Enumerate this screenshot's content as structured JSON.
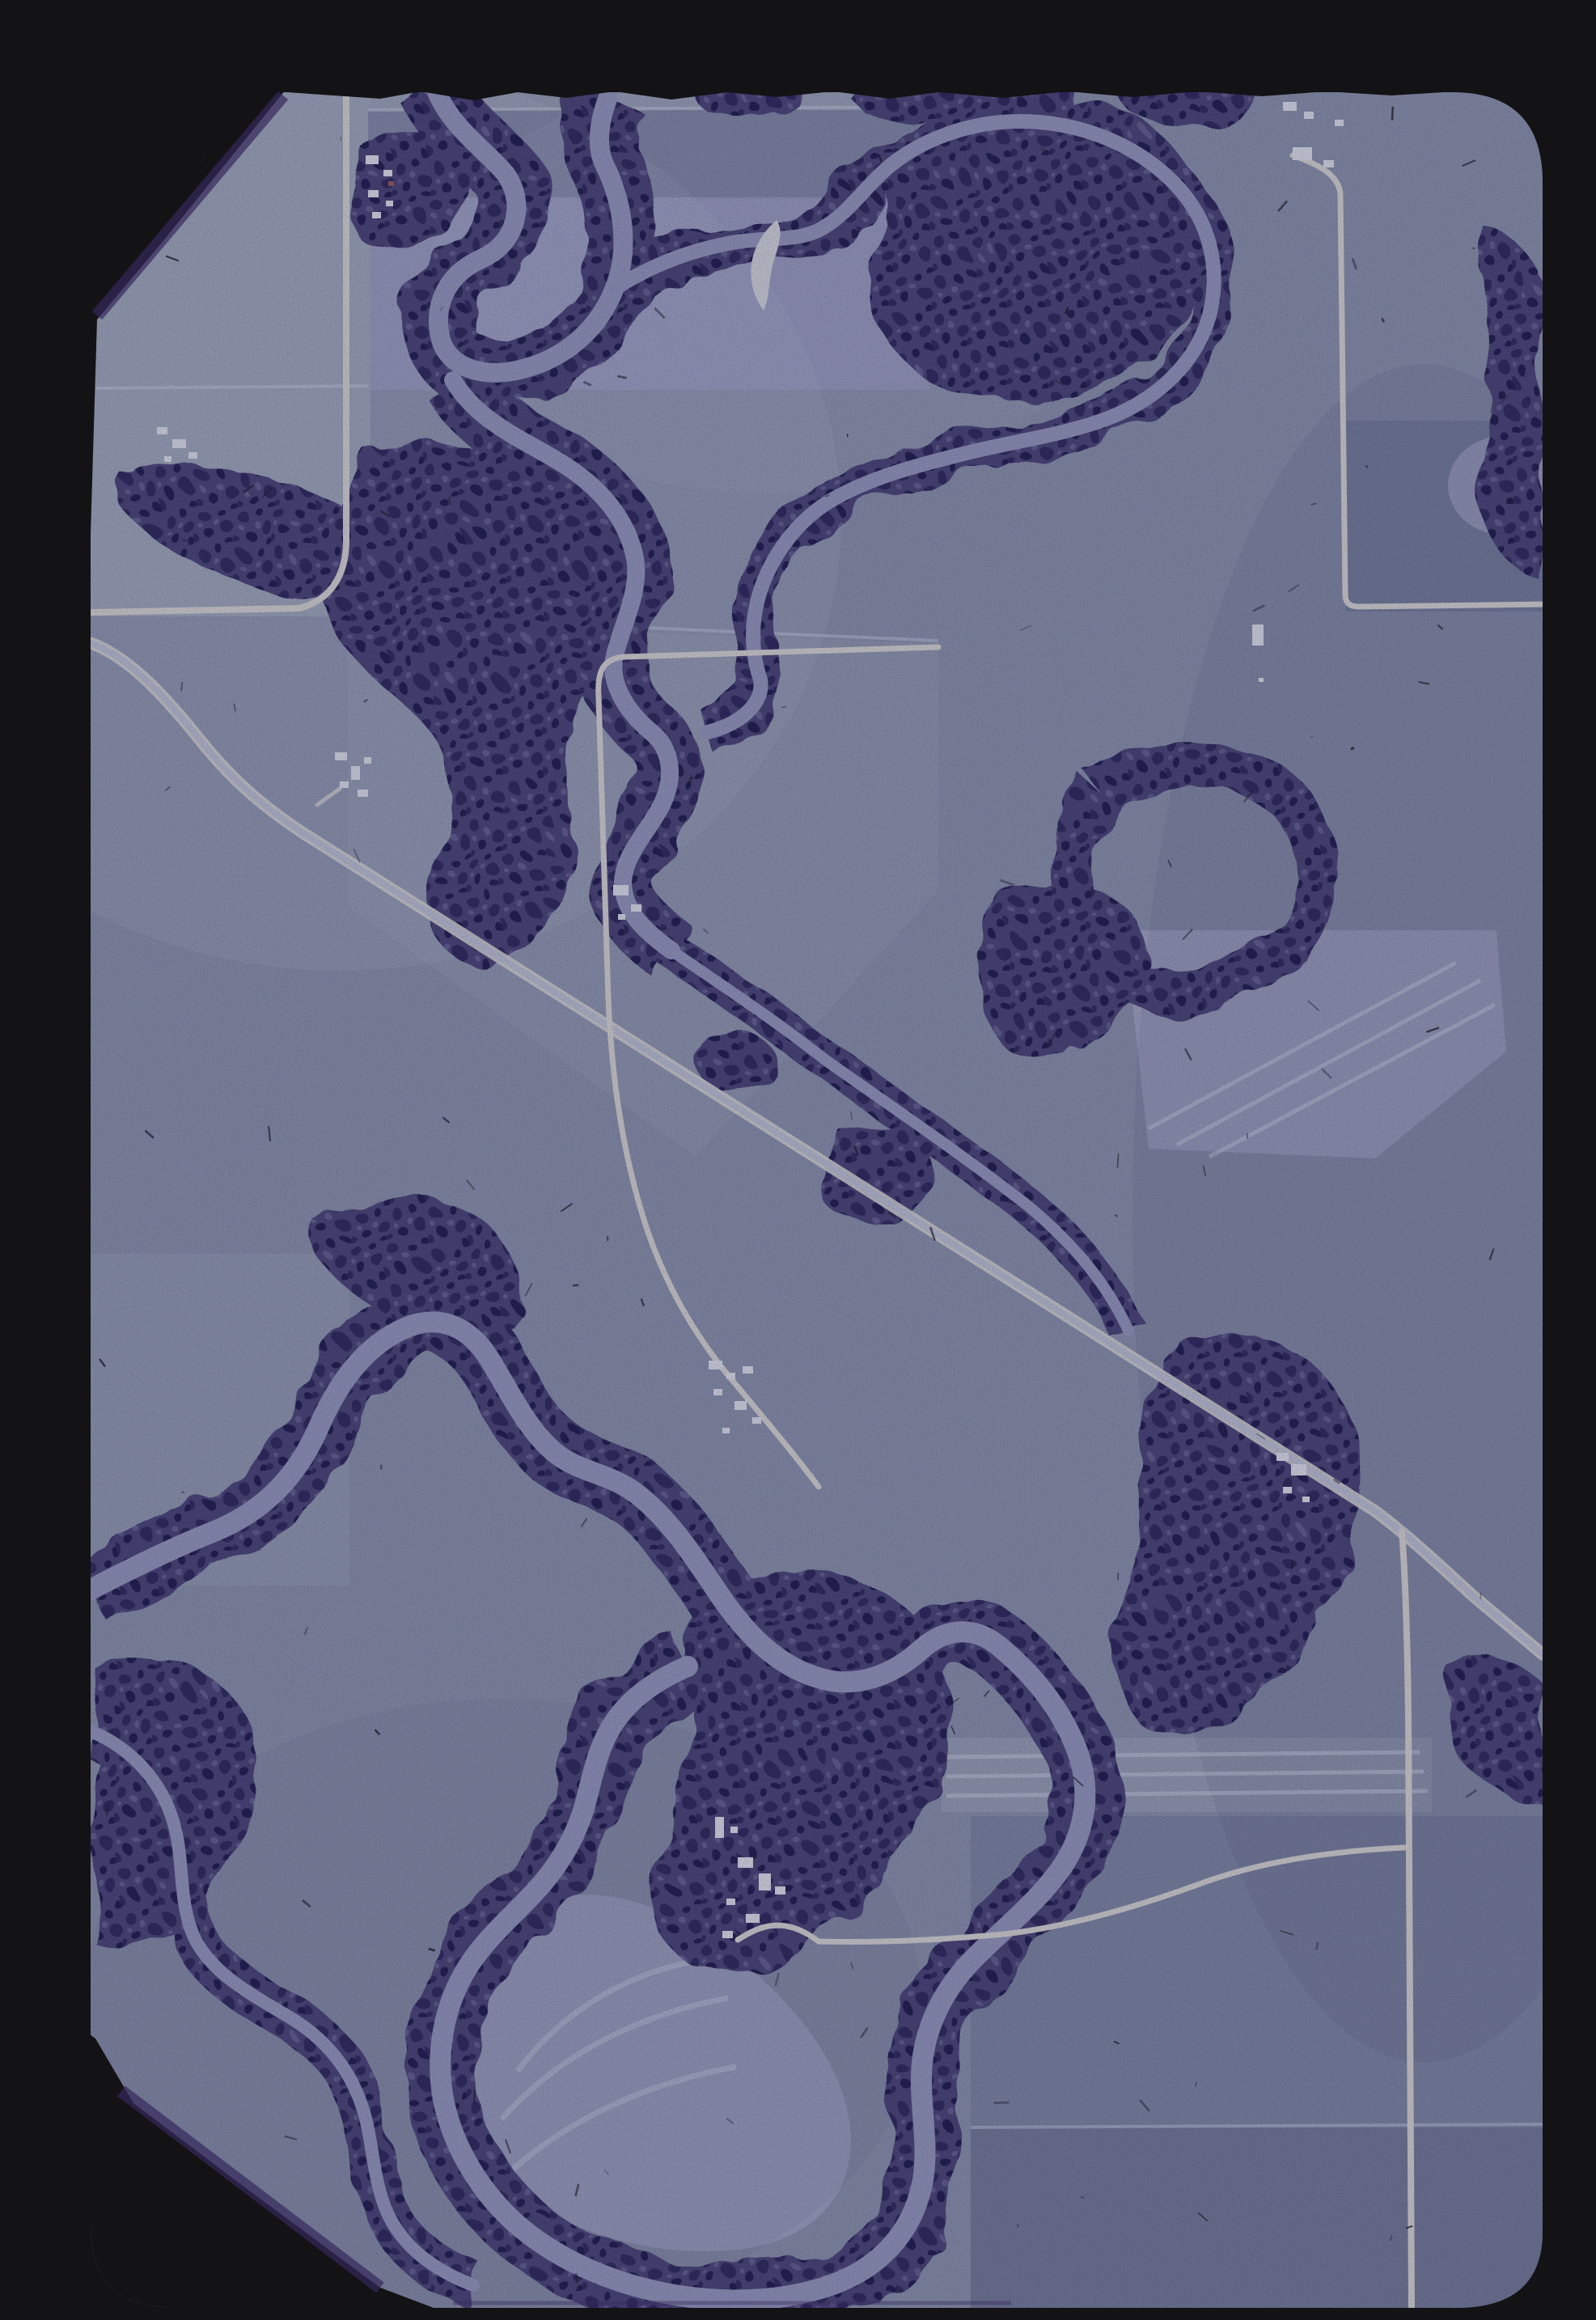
{
  "meta": {
    "domain": "Natural-Image",
    "description": "35mm color slide: vertical aerial photograph of river-bottomland farm country. A meandering tree-lined river crosses mosaic crop fields; a diagonal highway runs from upper-left to lower-right; white gravel section roads and small white-building farmsteads are scattered through the scene. Black slide mount with clipped top-left and bottom-left photo corners.",
    "orientation": "portrait"
  },
  "palette": {
    "mount": "#131215",
    "fringe": "#35295c",
    "field_base": "#98a0af",
    "field_light": "#a9b2bb",
    "field_pale": "#b4b6ca",
    "field_lavender": "#a6a7c4",
    "field_mid": "#8a91a6",
    "field_slate": "#828a9f",
    "field_dark": "#7b8298",
    "trees_base": "#555078",
    "trees_dark": "#37315c",
    "trees_deep": "#2b2750",
    "trees_light": "#6e6a92",
    "river": "#a2a5c0",
    "road_white": "#e7e5d8",
    "road_pale": "#ccd0d8",
    "building": "#eef1f0",
    "building_red": "#a4655c",
    "sandbar": "#e2e5e1",
    "speck": "#1d1b2a",
    "highlight": "#dde4e8",
    "shadow": "#3e3d5a"
  },
  "film": {
    "dust_count": 120
  },
  "features": {
    "photo": {
      "label": "aerial-photograph"
    },
    "rivers": [
      {
        "name": "upper-meandering-river"
      },
      {
        "name": "bulb-meander-side-channel"
      },
      {
        "name": "lower-meander-belt-and-oxbow-loop"
      },
      {
        "name": "left-bank-slough"
      }
    ],
    "roads": [
      {
        "name": "diagonal-highway"
      },
      {
        "name": "north-section-road"
      },
      {
        "name": "corner-section-road-and-farm-lane"
      },
      {
        "name": "northeast-farm-road"
      },
      {
        "name": "south-farm-road"
      },
      {
        "name": "southeast-section-road"
      }
    ],
    "farmsteads": [
      {
        "name": "north-left-farmstead"
      },
      {
        "name": "north-right-farmstead"
      },
      {
        "name": "west-farmstead"
      },
      {
        "name": "highway-west-farmstead"
      },
      {
        "name": "center-north-farmstead"
      },
      {
        "name": "center-farmstead"
      },
      {
        "name": "south-farmstead"
      },
      {
        "name": "southeast-farmstead"
      },
      {
        "name": "lone-barn"
      }
    ],
    "landcover": [
      {
        "name": "crop-field-mosaic"
      },
      {
        "name": "riparian-forest"
      },
      {
        "name": "point-bar-scroll-plain"
      },
      {
        "name": "strip-cropped-field"
      },
      {
        "name": "sandbar"
      }
    ]
  }
}
